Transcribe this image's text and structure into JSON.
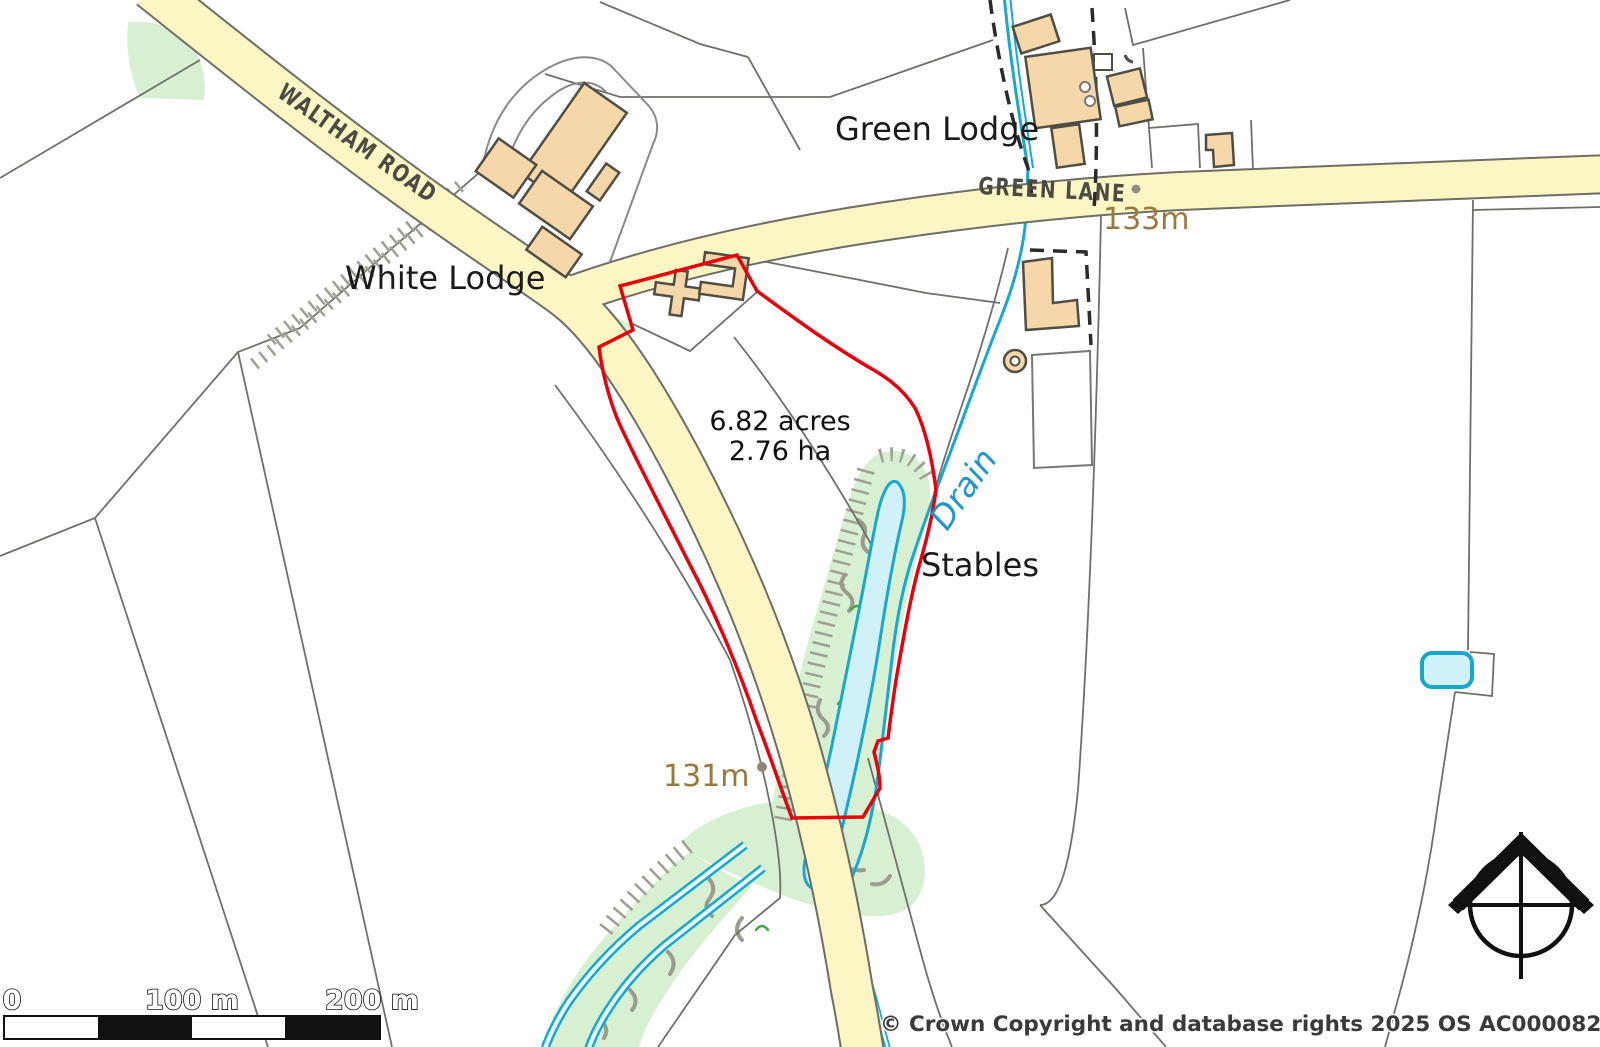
{
  "map": {
    "labels": {
      "waltham_road": "WALTHAM ROAD",
      "green_lane": "GREEN LANE",
      "white_lodge": "White Lodge",
      "green_lodge": "Green Lodge",
      "stables": "Stables",
      "drain": "Drain",
      "spot_height_133": "133m",
      "spot_height_131": "131m"
    },
    "parcel": {
      "area_acres": "6.82 acres",
      "area_hectares": "2.76 ha",
      "boundary_color": "#e8000d"
    },
    "scale_bar": {
      "labels": {
        "zero": "0",
        "mid": "100 m",
        "end": "200 m"
      }
    },
    "copyright": "© Crown Copyright and database rights 2025 OS AC0000829429",
    "icons": {
      "north_arrow": "north-arrow-icon"
    },
    "colors": {
      "road_fill": "#fbf6c3",
      "road_casing": "#6e6e66",
      "building_fill": "#f6d7a9",
      "building_stroke": "#4e4e44",
      "vegetation_green": "#d8f0d2",
      "water_fill": "#cff1f7",
      "water_stroke": "#18a8cc",
      "parcel_red": "#e8000d",
      "spot_height_text": "#9a7a3c",
      "drain_text": "#1e96ce",
      "road_text": "#4b4b44"
    }
  }
}
